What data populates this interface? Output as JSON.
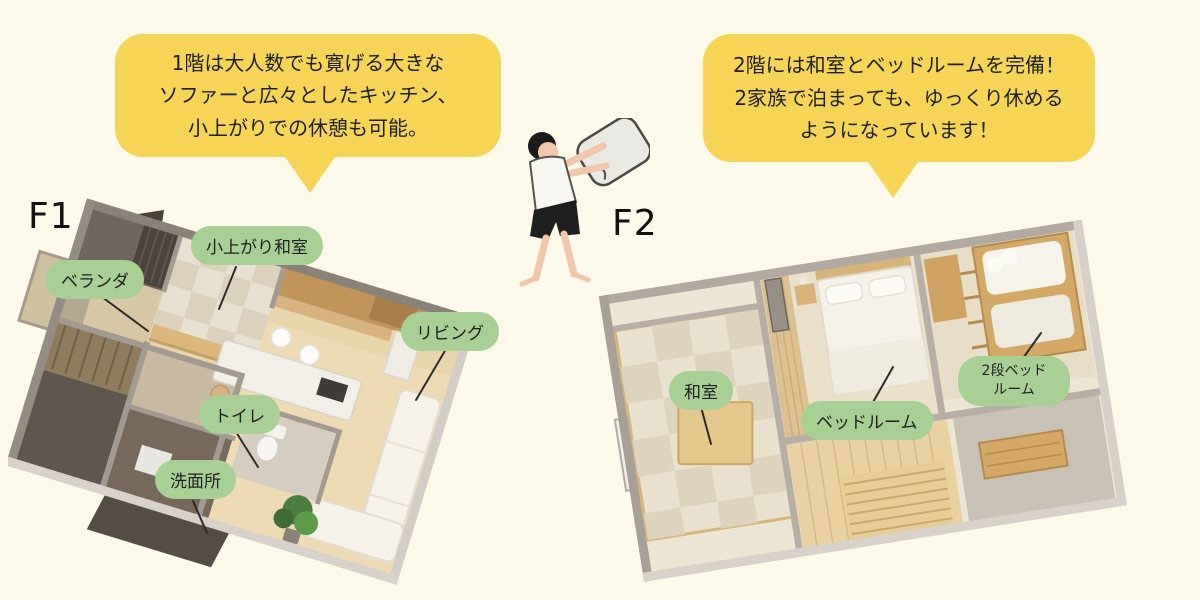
{
  "canvas": {
    "width": 1200,
    "height": 600,
    "background": "#FDF9EA"
  },
  "palette": {
    "bubble_yellow": "#F6D456",
    "pill_green": "#A8D094",
    "text_dark": "#1F1F1F",
    "wall_grey": "#9A918A",
    "wall_light": "#D6D0C8",
    "floor_wood": "#E9D5AC",
    "tatami_beige": "#E8E0D0",
    "cabinet_wood": "#C0955C",
    "sofa_white": "#F6F2E9",
    "plant_green": "#4C7F3F"
  },
  "annotations": {
    "bubble_f1": {
      "lines": [
        "1階は大人数でも寛げる大きな",
        "ソファーと広々としたキッチン、",
        "小上がりでの休憩も可能。"
      ]
    },
    "bubble_f2": {
      "lines": [
        "2階には和室とベッドルームを完備！",
        "2家族で泊まっても、ゆっくり休める",
        "ようになっています！"
      ]
    }
  },
  "floor1": {
    "label": "F1",
    "room_labels": {
      "veranda": "ベランダ",
      "koagari_washitsu": "小上がり和室",
      "living": "リビング",
      "toilet": "トイレ",
      "senmenjo": "洗面所"
    }
  },
  "floor2": {
    "label": "F2",
    "room_labels": {
      "washitsu": "和室",
      "bedroom": "ベッドルーム",
      "bunk_line1": "2段ベッド",
      "bunk_line2": "ルーム"
    }
  },
  "illustration": {
    "person": "person-shaking-pillow"
  }
}
